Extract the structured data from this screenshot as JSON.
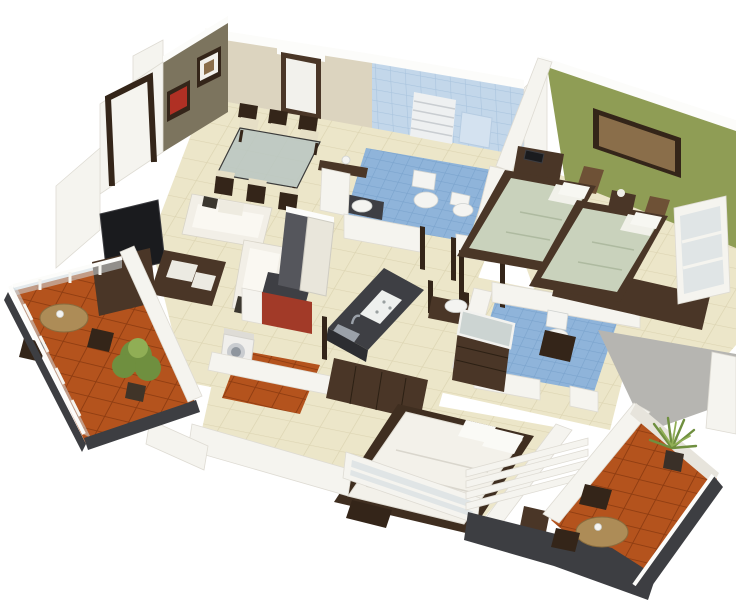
{
  "colors": {
    "bg": "#ffffff",
    "wallWhite": "#f5f4ef",
    "wallEdge": "#dedbd3",
    "wallShade": "#e7e4dc",
    "wallTop": "#fcfcfa",
    "wallBeige": "#dcd4bf",
    "wallOlive": "#7c745e",
    "wallGreen": "#8f9d55",
    "blueWallBase": "#c3d7ea",
    "blueWallLine": "#a9c4de",
    "blueFloorBase": "#8fb4da",
    "blueFloorLine": "#7aa3cd",
    "creamBase": "#ece6c9",
    "creamLine": "#dcd4b2",
    "orangeBase": "#b4531d",
    "orangeLine": "#8e3c11",
    "grayFloor": "#b6b5b1",
    "woodDark": "#4a3627",
    "woodDarker": "#342519",
    "woodMid": "#6e5136",
    "tableWood": "#ad8c57",
    "sage": "#c9d2bc",
    "whiteFabric": "#f2efe7",
    "cushionDark": "#3b372f",
    "black": "#1a1b1e",
    "counterDark": "#3e3f44",
    "steel": "#9ba1a9",
    "red": "#a23a28",
    "baseDark": "#3d3e42",
    "glass": "#cdd9df",
    "plantGreen": "#6f8f3f",
    "plantLight": "#90ae55",
    "artBrown": "#8a6e4a",
    "picRed": "#b03024",
    "mirror": "#ccd4d2",
    "blindWhite": "#f2f1ec",
    "radiator": "#eef0f1"
  },
  "scene": {
    "type": "3d-isometric-floor-plan-render",
    "rooms": [
      {
        "name": "entry-foyer",
        "features": [
          "olive-accent-wall",
          "two-framed-pictures",
          "open-door-frame"
        ]
      },
      {
        "name": "dining-area",
        "features": [
          "glass-top-table",
          "six-wood-chairs",
          "window-with-blind"
        ]
      },
      {
        "name": "bathroom-1",
        "features": [
          "blue-tiled-walls",
          "toilet",
          "bidet",
          "radiator",
          "wall-niche",
          "basin-vanity"
        ]
      },
      {
        "name": "twin-bedroom",
        "features": [
          "green-accent-wall",
          "framed-art",
          "two-single-beds",
          "nightstand-lamp",
          "study-desk",
          "long-desk-monitor",
          "tv-cabinet",
          "window"
        ]
      },
      {
        "name": "living-room",
        "features": [
          "white-l-sofa",
          "coffee-table",
          "tv",
          "tv-cabinet",
          "side-table-lamp"
        ]
      },
      {
        "name": "kitchen",
        "features": [
          "island-with-sink",
          "refrigerator",
          "red-cabinet",
          "counter",
          "washing-machine",
          "terracotta-strip"
        ]
      },
      {
        "name": "bathroom-2",
        "features": [
          "blue-tiled-floor",
          "toilet",
          "wash-basin",
          "dresser-with-mirror"
        ]
      },
      {
        "name": "master-bedroom",
        "features": [
          "double-bed-white-duvet",
          "wardrobe-unit",
          "nightstands",
          "railing-window"
        ]
      },
      {
        "name": "utility-room",
        "features": [
          "gray-floor"
        ]
      },
      {
        "name": "balcony-left",
        "features": [
          "terracotta-tiles",
          "round-wood-table",
          "two-chairs",
          "potted-plant",
          "glass-railing",
          "dark-fascia"
        ]
      },
      {
        "name": "balcony-right",
        "features": [
          "terracotta-tiles",
          "round-wood-table",
          "two-chairs",
          "potted-palm",
          "railing",
          "louvered-slats"
        ]
      }
    ]
  }
}
